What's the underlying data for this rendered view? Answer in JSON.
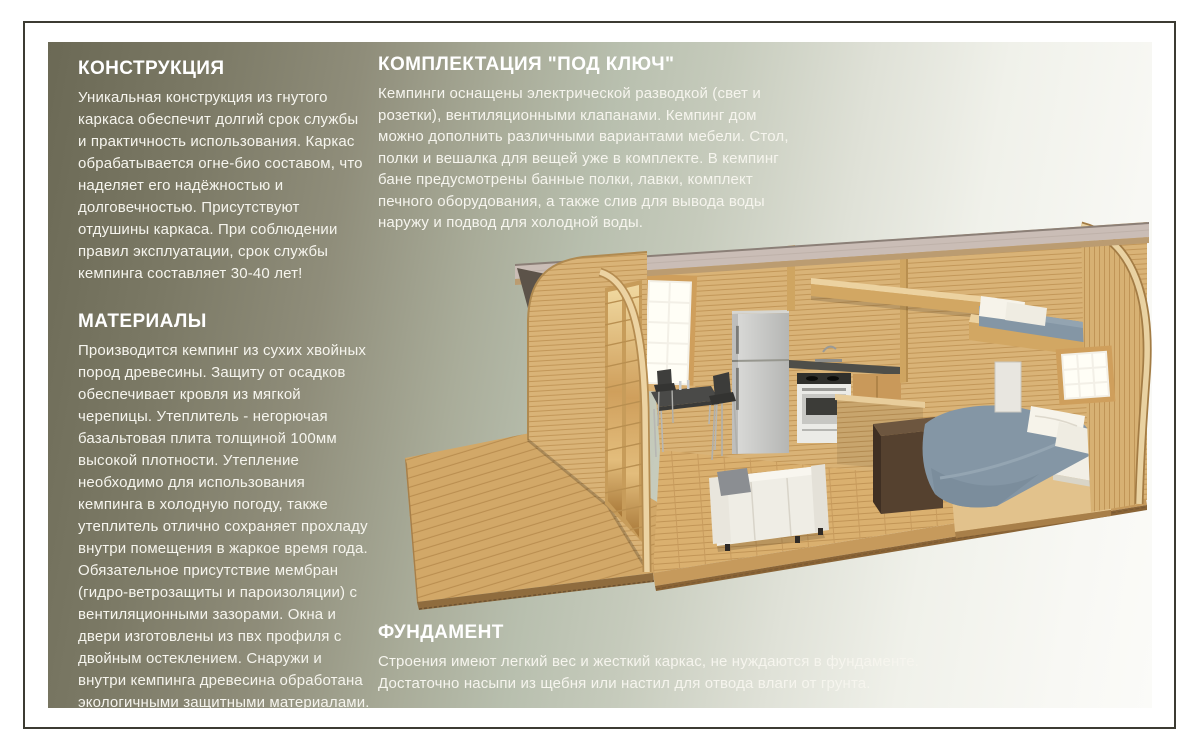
{
  "sections": {
    "construction": {
      "title": "КОНСТРУКЦИЯ",
      "body": "Уникальная конструкция из гнутого каркаса обеспечит долгий срок службы и практичность использования. Каркас обрабатывается огне-био составом, что наделяет его надёжностью и долговечностью. Присутствуют отдушины каркаса. При соблюдении правил эксплуатации, срок службы кемпинга составляет 30-40 лет!"
    },
    "materials": {
      "title": "МАТЕРИАЛЫ",
      "body": "Производится кемпинг из сухих хвойных пород древесины. Защиту от осадков обеспечивает кровля из мягкой черепицы. Утеплитель - негорючая базальтовая плита толщиной 100мм высокой плотности. Утепление необходимо для использования кемпинга в холодную погоду, также утеплитель отлично сохраняет прохладу внутри помещения в жаркое время года. Обязательное присутствие мембран (гидро-ветрозащиты и пароизоляции) с вентиляционными зазорами. Окна и двери изготовлены из пвх профиля с двойным остеклением. Снаружи и внутри кемпинга древесина обработана экологичными защитными материалами."
    },
    "equipment": {
      "title": "КОМПЛЕКТАЦИЯ \"ПОД КЛЮЧ\"",
      "body": "Кемпинги оснащены электрической разводкой (свет и розетки), вентиляционными клапанами. Кемпинг дом можно дополнить различными вариантами мебели. Стол, полки и вешалка для вещей уже в комплекте. В кемпинг бане предусмотрены банные полки, лавки, комплект печного оборудования, а также слив для вывода воды наружу и подвод для холодной воды."
    },
    "foundation": {
      "title": "ФУНДАМЕНТ",
      "body": "Строения имеют легкий вес и жесткий каркас, не нуждаются в фундаменте. Достаточно насыпи из щебня или настил для отвода влаги от грунта."
    }
  },
  "illustration": {
    "name": "camping-house-cutaway",
    "description": "3D cutaway of an arched wooden camping house: front deck, glazed doors, kitchen with fridge and stove, dining set, white sofa, double bed, loft bunk bed, two windows"
  },
  "palette": {
    "page_bg": "#ffffff",
    "frame": "#3c3b32",
    "gradient_left": "#6b6955",
    "gradient_mid": "#b8bfae",
    "gradient_right": "#f8f8f4",
    "text": "#f6f5ee",
    "wood_light": "#ecd3a2",
    "wood_mid": "#d9b377",
    "wood_dark": "#b08a50",
    "floor": "#dab06f",
    "roof": "#cabdb6",
    "mattress": "#8496a5",
    "fabric_white": "#f3f1ea",
    "fridge": "#c9c9c7",
    "counter": "#4e4e49",
    "desk": "#55412f"
  }
}
